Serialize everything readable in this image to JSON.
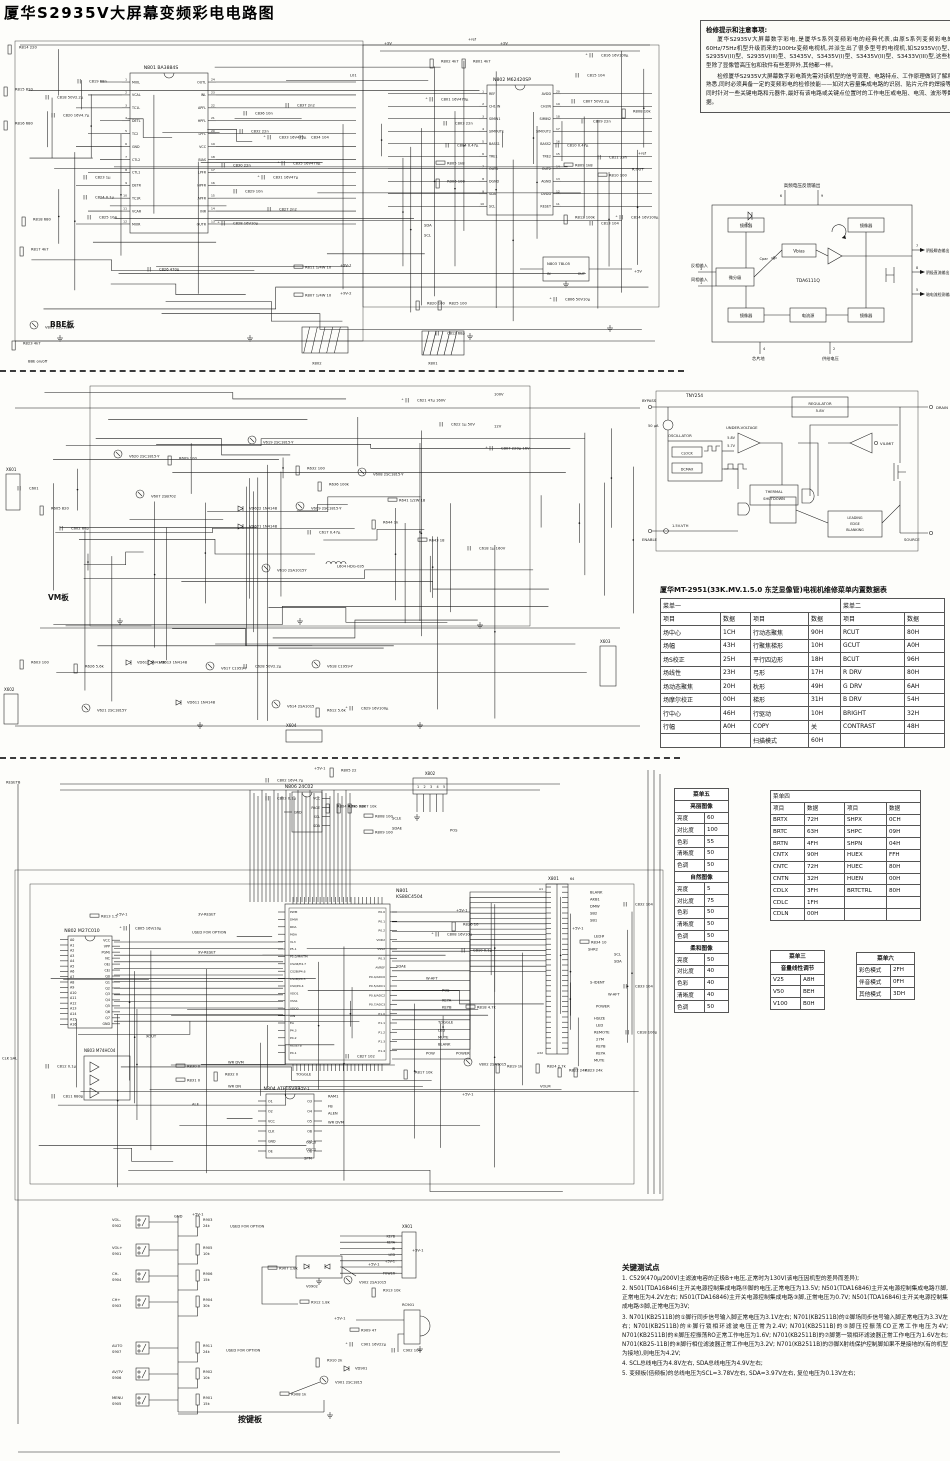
{
  "title": "厦华S2935V大屏幕变频彩电电路图",
  "notes": {
    "title": "检修提示和注意事项:",
    "p1": "厦华S2935V大屏幕数字彩电,是厦华S系列变频彩电的经典代表,由原S系列变频彩电的60Hz/75Hz机型升级而来的100Hz变频电视机,并派生出了很多型号的电视机,如S2935V(I)型、S2935V(II)型、S2935V(III)型、S3435V、S3435V(I)型、S3435V(II)型、S3433V(III)型,这些机型除了显像管高压包和软件有些差异外,其他都一样。",
    "p2": "检修厦华S2935V大屏幕数字彩电首先需对该机型的信号流程、电路特点、工作原理做到了解和熟悉,同时必须具备一定的变频彩电的检修技能——如对大容量集成电路的识别、贴片元件的焊接等,同时针对一些关键电路和元器件,最好有该电路或关键点位置时的工作电压或电阻、电流、波形等数据。"
  },
  "tda6111": {
    "chip": "TDA6111Q",
    "top_label": "高频电压反馈输出",
    "pins_top": [
      "6",
      "9"
    ],
    "zener": "7V",
    "cpar": "Cpar",
    "blocks": {
      "mirror": "镜像器",
      "vbias": "Vbias",
      "diff": "微分级",
      "isrc": "电流源"
    },
    "left_inputs": [
      {
        "pin": "3",
        "label": "反相输入"
      },
      {
        "pin": "1",
        "label": "同相输入"
      }
    ],
    "outputs": [
      {
        "pin": "7",
        "label": "阴极瞬态输出"
      },
      {
        "pin": "8",
        "label": "阴极直流输出"
      },
      {
        "pin": "5",
        "label": "暗电流检测输出"
      }
    ],
    "bottom": [
      {
        "pin": "4",
        "label": "芯片地"
      },
      {
        "pin": "2",
        "label": "供给电压"
      }
    ]
  },
  "tny254": {
    "chip": "TNY254",
    "terminals": {
      "bypass": "BYPASS",
      "drain": "DRAIN",
      "source": "SOURCE",
      "enable": "ENABLE",
      "vilimit": "VILIMIT"
    },
    "blocks": {
      "regulator1": "REGULATOR",
      "regulator2": "5.8V",
      "uv": "UNDER-VOLTAGE",
      "osc": "OSCILLATOR",
      "clock": "CLOCK",
      "dcmax": "DCMAX",
      "thermal1": "THERMAL",
      "thermal2": "SHUTDOWN",
      "leb1": "LEADING",
      "leb2": "EDGE",
      "leb3": "BLANKING"
    },
    "labels": {
      "current": "50 μA",
      "uv1": "5.8V",
      "uv2": "5.7V",
      "vth": "1.5V-VTH"
    }
  },
  "service_table": {
    "title": "厦华MT-2951(33K.MV.1.5.0 东芝显像管)电视机维修菜单内置数据表",
    "menu1": "菜单一",
    "menu2": "菜单二",
    "col_headers": [
      "项目",
      "数据",
      "项目",
      "数据",
      "项目",
      "数据"
    ],
    "rows": [
      [
        "场中心",
        "1CH",
        "行动态聚焦",
        "90H",
        "RCUT",
        "80H"
      ],
      [
        "场幅",
        "43H",
        "行聚焦梯形",
        "10H",
        "GCUT",
        "A0H"
      ],
      [
        "场S校正",
        "25H",
        "平行四边形",
        "18H",
        "BCUT",
        "96H"
      ],
      [
        "场线性",
        "23H",
        "弓形",
        "17H",
        "R DRV",
        "80H"
      ],
      [
        "场动态聚焦",
        "20H",
        "枕形",
        "49H",
        "G DRV",
        "6AH"
      ],
      [
        "场摩尔校正",
        "00H",
        "梯形",
        "31H",
        "B DRV",
        "54H"
      ],
      [
        "行中心",
        "46H",
        "行驱动",
        "10H",
        "BRIGHT",
        "32H"
      ],
      [
        "行幅",
        "A0H",
        "COPY",
        "关",
        "CONTRAST",
        "48H"
      ],
      [
        "",
        "",
        "扫描模式",
        "60H",
        "",
        ""
      ]
    ]
  },
  "menu5": {
    "title": "菜单五",
    "groups": [
      {
        "name": "亮丽图像",
        "rows": [
          [
            "亮度",
            "60"
          ],
          [
            "对比度",
            "100"
          ],
          [
            "色彩",
            "55"
          ],
          [
            "清晰度",
            "50"
          ],
          [
            "色调",
            "50"
          ]
        ]
      },
      {
        "name": "自然图像",
        "rows": [
          [
            "亮度",
            "5"
          ],
          [
            "对比度",
            "75"
          ],
          [
            "色彩",
            "50"
          ],
          [
            "清晰度",
            "50"
          ],
          [
            "色调",
            "50"
          ]
        ]
      },
      {
        "name": "柔和图像",
        "rows": [
          [
            "亮度",
            "50"
          ],
          [
            "对比度",
            "40"
          ],
          [
            "色彩",
            "40"
          ],
          [
            "清晰度",
            "40"
          ],
          [
            "色调",
            "50"
          ]
        ]
      }
    ]
  },
  "menu4": {
    "title": "菜单四",
    "col_headers": [
      "项目",
      "数据",
      "项目",
      "数据"
    ],
    "rows": [
      [
        "BRTX",
        "72H",
        "SHPX",
        "0CH"
      ],
      [
        "BRTC",
        "63H",
        "SHPC",
        "09H"
      ],
      [
        "BRTN",
        "4FH",
        "SHPN",
        "04H"
      ],
      [
        "CNTX",
        "90H",
        "HUEX",
        "FFH"
      ],
      [
        "CNTC",
        "72H",
        "HUEC",
        "80H"
      ],
      [
        "CNTN",
        "32H",
        "HUEN",
        "00H"
      ],
      [
        "CDLX",
        "3FH",
        "BRTCTRL",
        "80H"
      ],
      [
        "CDLC",
        "1FH",
        "",
        ""
      ],
      [
        "CDLN",
        "00H",
        "",
        ""
      ]
    ]
  },
  "menu3": {
    "title": "菜单三",
    "subtitle": "音量线性调节",
    "rows": [
      [
        "V25",
        "A8H"
      ],
      [
        "V50",
        "BEH"
      ],
      [
        "V100",
        "B0H"
      ]
    ]
  },
  "menu6": {
    "title": "菜单六",
    "rows": [
      [
        "彩色模式",
        "2FH"
      ],
      [
        "伴音模式",
        "0FH"
      ],
      [
        "其他模式",
        "3DH"
      ]
    ]
  },
  "test_points": {
    "title": "关键测试点",
    "items": [
      "1. C529(470μ/200V)主滤波电容的正极B+电压,正常时为130V(该电压因机型的差异而差异);",
      "2. N501(TDA16846)主开关电源控制集成电路⑭脚的电压,正常电压为13.5V; N501(TDA16846)主开关电源控制集成电路⑪脚,正常电压为4.2V左右; N501(TDA16846)主开关电源控制集成电路③脚,正常电压为0.7V; N501(TDA16846)主开关电源控制集成电路⑤脚,正常电压为3V;",
      "3. N701(KB2511B)的①脚行同步信号输入脚正常电压为3.1V左右; N701(KB2511B)的②脚场同步信号输入脚正常电压为3.3V左右; N701(KB2511B)的④脚行锁相环滤波电压正常为2.4V; N701(KB2511B)的⑤脚压控振荡CO正常工作电压为4V; N701(KB2511B)的⑥脚压控振荡RO正常工作电压为1.6V; N701(KB2511B)的⑦脚第一锁相环滤波器正常工作电压为1.6V左右; N701(KB25-11B)的⑧脚行相位滤波器正常工作电压为3.2V; N701(KB2511B)的㉓脚X射线保护控制脚如果不是接地的(有的机型为接地),则电压为4.2V;",
      "4. SCL总线电压为4.8V左右, SDA总线电压为4.9V左右;",
      "5. 变频板(倍频板)的总线电压为SCL=3.78V左右, SDA=3.97V左右, 复位电压为0.13V左右;"
    ]
  },
  "sections": {
    "bbe": {
      "board_label": "BBE板",
      "ics": [
        {
          "ref": "N801",
          "part": "BA3884S",
          "left": [
            "MIXL",
            "VCAL",
            "TC1L",
            "DETL",
            "TC2",
            "GND",
            "CTL2",
            "CTL1",
            "DETR",
            "TC1R",
            "VCAR",
            "MIXR"
          ],
          "right": [
            "OUTL",
            "INL",
            "APFL",
            "HPFL",
            "LPFL",
            "VCC",
            "BIAS",
            "LPFR",
            "HPFR",
            "APFR",
            "INR",
            "OUTR"
          ]
        },
        {
          "ref": "N802",
          "part": "M62420SP",
          "left": [
            "REF",
            "CH1 IN",
            "SIMIN1",
            "SIMOUT1",
            "BASS1",
            "TRE1",
            "OUT1",
            "DGND",
            "SDA",
            "SCL"
          ],
          "right": [
            "AVDD",
            "CH2IN",
            "SIMIN2",
            "SIMOUT2",
            "BASS2",
            "TRE2",
            "OUT2",
            "AGND",
            "DVDD",
            "RESET"
          ]
        },
        {
          "ref": "N803",
          "part": "78L05",
          "left": [
            "IN"
          ],
          "right": [
            "OUT"
          ]
        }
      ],
      "connectors": [
        "X802",
        "X801"
      ],
      "labels": [
        "R814 220",
        "R815 820",
        "R816 680",
        "R818 680",
        "R817 4k7",
        "C818 50V2.2μ",
        "C819 68n",
        "C820 16V4.7μ",
        "C823 1μ",
        "C824 0.1μ",
        "C825 104",
        "C826 470p",
        "V801 2SC1815Y",
        "R823 4k7",
        "BBE on/off",
        "C837 2n2",
        "C836 10n",
        "C832 22n",
        "C833 16V470μ",
        "C834 104",
        "C835 16V470μ",
        "C830 22n",
        "C831 16V47μ",
        "C829 10n",
        "C827 2n2",
        "C828 16V10μ",
        "R802 4k7",
        "R801 4k7",
        "C816 16V100μ",
        "C815 104",
        "C801 16V470μ",
        "C807 50V2.2μ",
        "R808 10k",
        "C803 22n",
        "C809 22n",
        "C804 0.47μ",
        "C810 0.47μ",
        "C811 33n",
        "R805 1k8",
        "R809 1k8",
        "R806 100",
        "R810 100",
        "R812 100k",
        "C813 104",
        "C814 16V100μ",
        "SDA",
        "SCL",
        "R811 1/4W 10",
        "+9V-1",
        "R807 1/4W 10",
        "+9V-2",
        "R820 100",
        "R825 100",
        "C812 68p",
        "C806 50V10μ",
        "+5V",
        "+9V",
        "+9V",
        "+ref",
        "+ref",
        "L01",
        "R.OUT",
        "X802",
        "X801"
      ]
    },
    "vm": {
      "board_label": "VM板",
      "connectors": [
        "X601",
        "X602",
        "X603",
        "X604"
      ],
      "labels": [
        "C601",
        "R605 820",
        "C602 68p",
        "V620 2SC1815-Y",
        "V619 2SC1815-Y",
        "R609 100",
        "V607 2SB702",
        "VD622 1N4148",
        "VD621 1N4148",
        "R632 100",
        "R636 100k",
        "V609 2SC1815-Y",
        "C617 0.47μ",
        "V608 2SC1815-Y",
        "L604 HDG-035",
        "R641 1/2W 18",
        "R643 18",
        "C618 1μ 160V",
        "C807 220μ 16V",
        "V610 2SA1015Y",
        "R644 1k",
        "C621 47μ 160V",
        "C622 1μ 50V",
        "100V",
        "12V",
        "V621 2SC1815Y",
        "V614 2SA1015",
        "R612 5.6k",
        "C629 16V100μ",
        "VD611 1N4148",
        "VD612 1N4148",
        "VD613 1N4148",
        "R626 5.6k",
        "R603 100",
        "V617 C1959-Y",
        "C628 50V2.2μ",
        "V618 C1959-Y"
      ]
    },
    "main": {
      "ics": [
        {
          "ref": "N801",
          "part": "KS88C4504",
          "left": [
            "PWM",
            "DMW",
            "RDA",
            "MDA",
            "VL3",
            "P5.1",
            "P5.0/MAITM",
            "CS2#/P4.7",
            "CS2B/P4.6",
            "CS1B/P4.5",
            "CS0/P4.4",
            "VDD1",
            "VSS1",
            "VDD0",
            "XIN",
            "EA",
            "P4.3",
            "P4.2",
            "RESETB",
            "P4.1"
          ],
          "right": [
            "P0.0",
            "P0.1",
            "P0.2",
            "VDD2",
            "VSS2",
            "P0.3",
            "AVREF",
            "P0.4/ADC0",
            "P0.5/ADC1",
            "P0.6/ADC2",
            "P0.7/ADC3",
            "P1.0",
            "P1.1",
            "P1.2",
            "P1.3",
            "P1.4"
          ]
        },
        {
          "ref": "N802",
          "part": "M27C010",
          "left": [
            "A0",
            "A1",
            "A2",
            "A3",
            "A4",
            "A5",
            "A6",
            "A7",
            "A8",
            "A9",
            "A10",
            "A11",
            "A12",
            "A13",
            "A14",
            "A15",
            "A16"
          ],
          "right": [
            "VCC",
            "VPP",
            "PGM/",
            "NC",
            "OE/",
            "CE/",
            "Q0",
            "Q1",
            "Q2",
            "Q3",
            "Q4",
            "Q5",
            "Q6",
            "Q7",
            "GND"
          ]
        },
        {
          "ref": "N803",
          "part": "M74HC04",
          "left": [],
          "right": []
        },
        {
          "ref": "N804",
          "part": "ATF16V8B",
          "left": [
            "O1",
            "O2",
            "VCC",
            "CLK",
            "GND",
            "OE"
          ],
          "right": [
            "O3",
            "O4",
            "O5",
            "O6",
            "O7",
            "O8"
          ]
        },
        {
          "ref": "N806",
          "part": "24C02",
          "left": [
            "GND"
          ],
          "right": [
            "VCC",
            "PAGE",
            "SCL",
            "SDA"
          ]
        }
      ],
      "connectors": {
        "x801": {
          "ref": "X801",
          "a_first": "A1",
          "a_last": "A32",
          "b_note": "64"
        },
        "x802": {
          "ref": "X802",
          "pins": [
            "1",
            "2",
            "3",
            "4",
            "5"
          ]
        }
      },
      "labels": [
        "C802 16V4.7μ",
        "C803 0.1μ",
        "R805 22",
        "+5V-1",
        "R804 4.7k",
        "R806 10k",
        "R807 10k",
        "R808 100",
        "R809 100",
        "SCLE",
        "SDAE",
        "POS",
        "RESETB",
        "3V-RESET",
        "9V-RESET",
        "USED FOR OPTION",
        "R813 1.5",
        "+5V-1",
        "C805 16V/10μ",
        "XOUT",
        "C812 0.1μ",
        "C811 680p",
        "CLK SAL",
        "R830 0",
        "R831 0",
        "R832 0",
        "WR DVM",
        "WR DN",
        "ALE",
        "TOGGLE",
        "C827 102",
        "RAM1",
        "FB",
        "ALEN",
        "WR DVM",
        "OSC0",
        "OSC1",
        "SPM",
        "C808 16V10μ",
        "R820 10",
        "+5V-1",
        "C810 0.1μ",
        "SDAE",
        "W-AFT",
        "POS",
        "KEYA",
        "KEYB",
        "R818 4.7k",
        "TOGGLE",
        "LED",
        "MUTE",
        "BLANK",
        "POW",
        "POWER",
        "R817 10k",
        "V802 2SA1015",
        "R819 1k",
        "+5V-1",
        "BLANK",
        "AKB1",
        "DMW",
        "SB2",
        "SB1",
        "+5V-1",
        "LED#",
        "R834 10",
        "SHR2",
        "SCL",
        "SDA",
        "S-IDENT",
        "W-AFT",
        "POWER",
        "HSIZE",
        "LED",
        "REMOTE",
        "27M",
        "KEYB",
        "KEYA",
        "MUTE",
        "C832 104",
        "C833 104",
        "C818 100p",
        "R822 24k",
        "R823 24k",
        "R824 2.7k",
        "VOLM",
        "+5V-1"
      ]
    },
    "keypad": {
      "board_label": "按键板",
      "buttons": [
        {
          "name": "VOL-",
          "ref": "S902"
        },
        {
          "name": "VOL+",
          "ref": "S901"
        },
        {
          "name": "CH-",
          "ref": "S904"
        },
        {
          "name": "CH+",
          "ref": "S903"
        },
        {
          "name": "AUTO",
          "ref": "S907"
        },
        {
          "name": "AV/TV",
          "ref": "S906"
        },
        {
          "name": "MENU",
          "ref": "S905"
        }
      ],
      "resistors": [
        "R903 24k",
        "R905 10k",
        "R906 15k",
        "R904 30k",
        "R911 24k",
        "R902 10k",
        "R901 15k"
      ],
      "parts": [
        "GND",
        "+5V-1",
        "USED FOR OPTION",
        "USED FOR OPTION",
        "+5V-1",
        "R907 1.8k",
        "V0902",
        "V902 2SA1015",
        "R912 1.8k",
        "R913 10k",
        "+5V-1",
        "R909 47",
        "+5V-1",
        "C901 16V22μ",
        "C902 104",
        "R910 2k",
        "VD901",
        "V901 2SC1815",
        "R908 1k"
      ],
      "connector": {
        "ref": "X901",
        "pins": [
          "KEYB",
          "KEYA",
          "IR",
          "LED",
          "+5V-1",
          "",
          "POWER"
        ]
      },
      "receiver": "RC901"
    }
  }
}
